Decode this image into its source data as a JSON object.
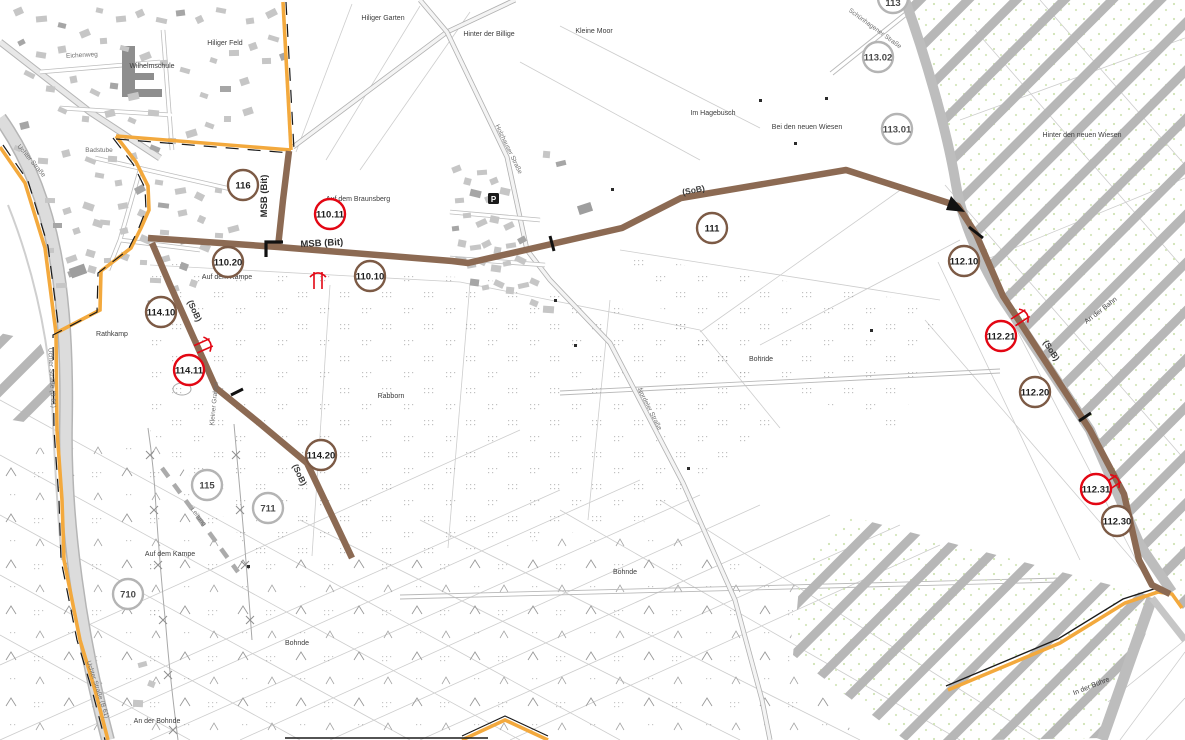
{
  "map": {
    "colors": {
      "route_brown": "#8c6a53",
      "boundary_yellow": "#f3a93d",
      "boundary_black": "#1a1a1a",
      "badge_brown": "#7c5a45",
      "badge_red": "#e30613",
      "badge_gray": "#b4b4b4",
      "hatch_gray": "#b7b7b7",
      "road_gray": "#c4c4c4"
    },
    "symbols": {
      "parking": "P"
    },
    "badges": [
      {
        "label": "113",
        "type": "gray",
        "x": 893,
        "y": -2,
        "r": 15,
        "ty": 8
      },
      {
        "label": "113.02",
        "type": "gray",
        "x": 878,
        "y": 57,
        "r": 15,
        "ty": 3.5
      },
      {
        "label": "113.01",
        "type": "gray",
        "x": 897,
        "y": 129,
        "r": 15,
        "ty": 3.5
      },
      {
        "label": "116",
        "type": "brown",
        "x": 243,
        "y": 185,
        "r": 15,
        "ty": 3.5
      },
      {
        "label": "110.11",
        "type": "red",
        "x": 330,
        "y": 214,
        "r": 15,
        "ty": 3.5
      },
      {
        "label": "110.20",
        "type": "brown",
        "x": 228,
        "y": 262,
        "r": 15,
        "ty": 3.5
      },
      {
        "label": "110.10",
        "type": "brown",
        "x": 370,
        "y": 276,
        "r": 15,
        "ty": 3.5
      },
      {
        "label": "111",
        "type": "brown",
        "x": 712,
        "y": 228,
        "r": 15,
        "ty": 3.5
      },
      {
        "label": "112.10",
        "type": "brown",
        "x": 964,
        "y": 261,
        "r": 15,
        "ty": 3.5
      },
      {
        "label": "112.21",
        "type": "red",
        "x": 1001,
        "y": 336,
        "r": 15,
        "ty": 3.5
      },
      {
        "label": "112.20",
        "type": "brown",
        "x": 1035,
        "y": 392,
        "r": 15,
        "ty": 3.5
      },
      {
        "label": "112.31",
        "type": "red",
        "x": 1096,
        "y": 489,
        "r": 15,
        "ty": 3.5
      },
      {
        "label": "112.30",
        "type": "brown",
        "x": 1117,
        "y": 521,
        "r": 15,
        "ty": 3.5
      },
      {
        "label": "114.10",
        "type": "brown",
        "x": 161,
        "y": 312,
        "r": 15,
        "ty": 3.5
      },
      {
        "label": "114.11",
        "type": "red",
        "x": 189,
        "y": 370,
        "r": 15,
        "ty": 3.5
      },
      {
        "label": "114.20",
        "type": "brown",
        "x": 321,
        "y": 455,
        "r": 15,
        "ty": 3.5
      },
      {
        "label": "115",
        "type": "gray",
        "x": 207,
        "y": 485,
        "r": 15,
        "ty": 3.5
      },
      {
        "label": "711",
        "type": "gray",
        "x": 268,
        "y": 508,
        "r": 15,
        "ty": 3.5
      },
      {
        "label": "710",
        "type": "gray",
        "x": 128,
        "y": 594,
        "r": 15,
        "ty": 3.5
      }
    ],
    "route_labels": [
      {
        "text": "MSB (Bit)",
        "x": 322,
        "y": 246,
        "rot": -3,
        "cls": "route"
      },
      {
        "text": "MSB (Bit)",
        "x": 267,
        "y": 196,
        "rot": -90,
        "cls": "route"
      },
      {
        "text": "(SoB)",
        "x": 192,
        "y": 312,
        "rot": 65,
        "cls": "sob"
      },
      {
        "text": "(SoB)",
        "x": 297,
        "y": 476,
        "rot": 65,
        "cls": "sob"
      },
      {
        "text": "(SoB)",
        "x": 694,
        "y": 193,
        "rot": -11,
        "cls": "sob"
      },
      {
        "text": "(SoB)",
        "x": 1049,
        "y": 352,
        "rot": 57,
        "cls": "sob"
      }
    ],
    "place_labels": [
      {
        "text": "Hiliger Feld",
        "x": 225,
        "y": 45,
        "rot": 0,
        "cls": "place"
      },
      {
        "text": "Hiliger Garten",
        "x": 383,
        "y": 20,
        "rot": 0,
        "cls": "place"
      },
      {
        "text": "Hinter der Billige",
        "x": 489,
        "y": 36,
        "rot": 0,
        "cls": "place"
      },
      {
        "text": "Kleine Moor",
        "x": 594,
        "y": 33,
        "rot": 0,
        "cls": "place"
      },
      {
        "text": "Im Hagebusch",
        "x": 713,
        "y": 115,
        "rot": 0,
        "cls": "place"
      },
      {
        "text": "Bei den neuen Wiesen",
        "x": 807,
        "y": 129,
        "rot": 0,
        "cls": "place"
      },
      {
        "text": "Hinter den neuen Wiesen",
        "x": 1082,
        "y": 137,
        "rot": 0,
        "cls": "place"
      },
      {
        "text": "Auf dem Braunsberg",
        "x": 358,
        "y": 201,
        "rot": 0,
        "cls": "place"
      },
      {
        "text": "Auf dem Kampe",
        "x": 227,
        "y": 279,
        "rot": 0,
        "cls": "place"
      },
      {
        "text": "Rathkamp",
        "x": 112,
        "y": 336,
        "rot": 0,
        "cls": "place"
      },
      {
        "text": "Rabborn",
        "x": 391,
        "y": 398,
        "rot": 0,
        "cls": "place"
      },
      {
        "text": "Auf dem Kampe",
        "x": 170,
        "y": 556,
        "rot": 0,
        "cls": "place"
      },
      {
        "text": "Bohnde",
        "x": 761,
        "y": 361,
        "rot": 0,
        "cls": "place"
      },
      {
        "text": "Bohnde",
        "x": 625,
        "y": 574,
        "rot": 0,
        "cls": "place"
      },
      {
        "text": "Bohnde",
        "x": 297,
        "y": 645,
        "rot": 0,
        "cls": "place"
      },
      {
        "text": "An der Bohnde",
        "x": 157,
        "y": 723,
        "rot": 0,
        "cls": "place"
      },
      {
        "text": "An der Bahn",
        "x": 1102,
        "y": 312,
        "rot": -38,
        "cls": "place"
      },
      {
        "text": "In der Bühre",
        "x": 1092,
        "y": 688,
        "rot": -22,
        "cls": "place"
      },
      {
        "text": "Wilhelmschule",
        "x": 152,
        "y": 68,
        "rot": 0,
        "cls": "place"
      },
      {
        "text": "Badstube",
        "x": 99,
        "y": 152,
        "rot": 0,
        "cls": "road"
      },
      {
        "text": "Eichenweg",
        "x": 82,
        "y": 57,
        "rot": -3,
        "cls": "road"
      },
      {
        "text": "Uchter Straße",
        "x": 30,
        "y": 162,
        "rot": 50,
        "cls": "road"
      },
      {
        "text": "Uchter Straße (B 61)",
        "x": 50,
        "y": 378,
        "rot": 87,
        "cls": "road"
      },
      {
        "text": "Uchter Straße (B 61)",
        "x": 96,
        "y": 690,
        "rot": 72,
        "cls": "road"
      },
      {
        "text": "Holzhauser Straße",
        "x": 507,
        "y": 150,
        "rot": 64,
        "cls": "road"
      },
      {
        "text": "Nordeler Straße",
        "x": 648,
        "y": 410,
        "rot": 63,
        "cls": "road"
      },
      {
        "text": "Schünhagener Straße",
        "x": 874,
        "y": 30,
        "rot": 36,
        "cls": "road"
      },
      {
        "text": "Kleiner Graben",
        "x": 216,
        "y": 404,
        "rot": -84,
        "cls": "road"
      },
      {
        "text": "Leitung",
        "x": 197,
        "y": 518,
        "rot": 52,
        "cls": "road"
      }
    ]
  }
}
